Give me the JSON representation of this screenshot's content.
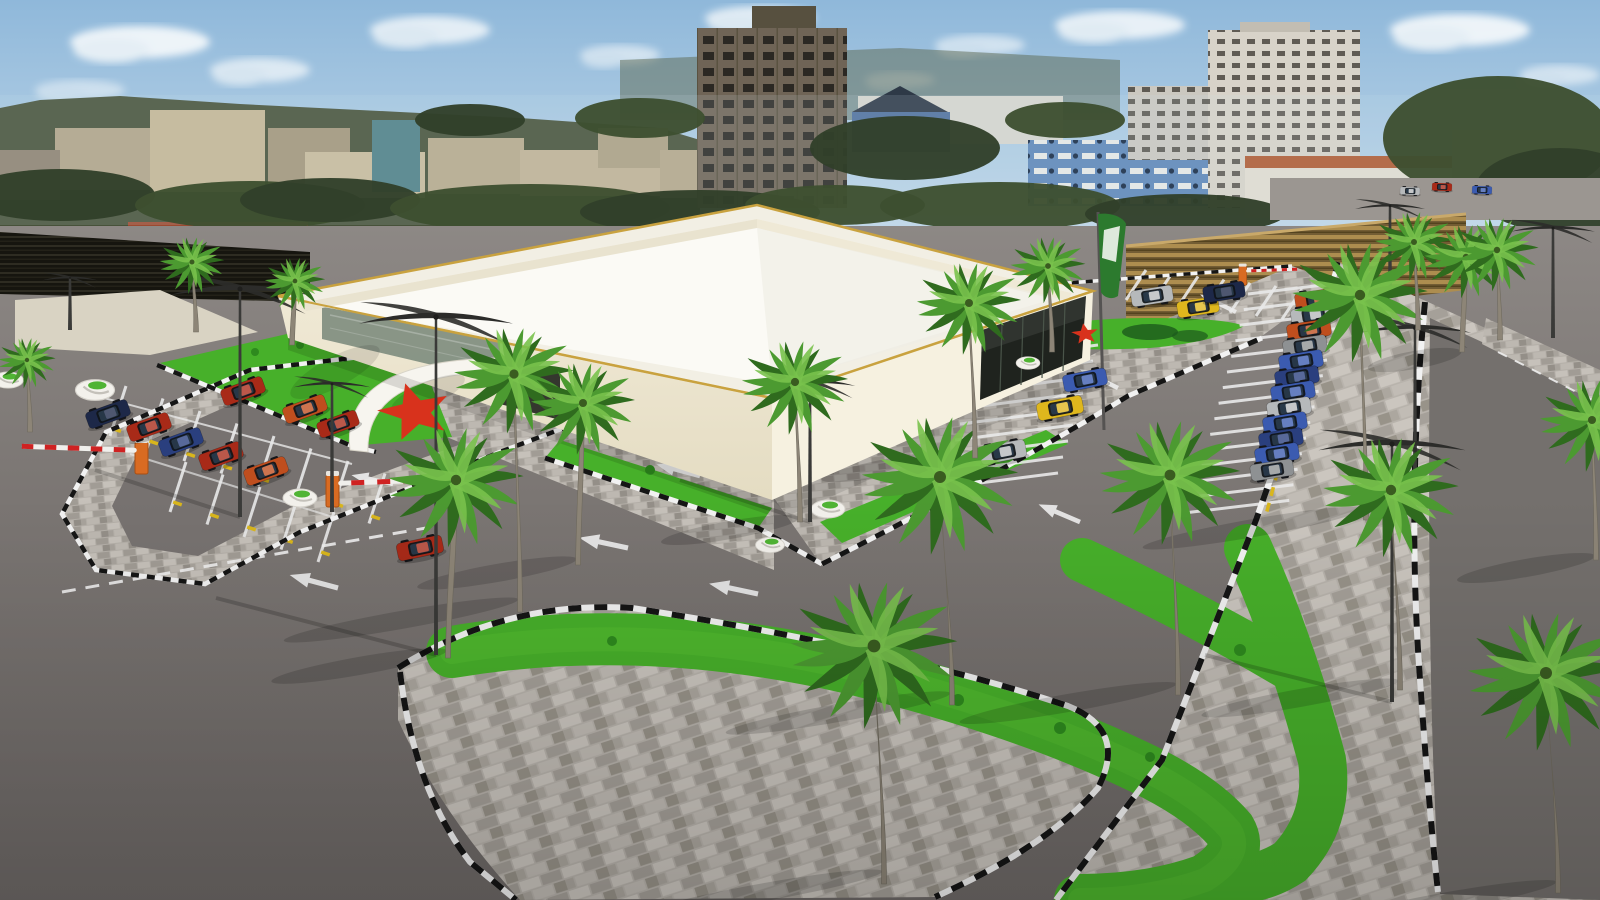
{
  "scene": {
    "description": "3D architectural rendering of a supermarket building with landscaped parking lot, palm trees and city skyline",
    "palette": {
      "skyTop": "#8fb8da",
      "skyBottom": "#dcE9f2",
      "cloud": "#f7fafc",
      "asphalt": "#7b7673",
      "asphaltFar": "#8d8885",
      "paver": "#b4afa8",
      "paverLight": "#c6c1ba",
      "paverDark": "#a19c95",
      "curbBlack": "#151515",
      "curbWhite": "#f2f2f2",
      "grass": "#47b02a",
      "grassLight": "#63cb38",
      "bush": "#2e8a1e",
      "wall": "#ece5cf",
      "wallRight": "#f6f1e0",
      "roof": "#fbfaf5",
      "parapet": "#f2efe4",
      "gold": "#c9a23f",
      "glassDark": "#1f231e",
      "starRed": "#d8321c",
      "trunk": "#8d8577",
      "palmDark": "#2f6b1e",
      "palmMid": "#4c9a31",
      "palmLight": "#79c24d",
      "hedge": "#31402a",
      "hedge2": "#3d4f30",
      "fenceGold": "#ad8d4f",
      "lampMetal": "#2c2c2a",
      "barrierOrange": "#d96b22",
      "carRed": "#a82a18",
      "carOrange": "#bf4e1e",
      "carNavy": "#1d2848",
      "carBlueDk": "#2a3f7e",
      "carBlue": "#3b5bb0",
      "carSilver": "#b6b9bb",
      "carGray": "#8e9193",
      "carYellow": "#dfb71d",
      "flagGreen": "#2c7a2e",
      "flagWhite": "#e8efe6"
    },
    "render": {
      "clouds": [
        [
          140,
          42,
          70,
          16,
          0.9
        ],
        [
          260,
          70,
          50,
          12,
          0.7
        ],
        [
          430,
          30,
          60,
          14,
          0.8
        ],
        [
          620,
          55,
          40,
          10,
          0.6
        ],
        [
          760,
          18,
          55,
          12,
          0.8
        ],
        [
          980,
          45,
          45,
          10,
          0.6
        ],
        [
          1120,
          25,
          65,
          14,
          0.85
        ],
        [
          1300,
          55,
          45,
          11,
          0.7
        ],
        [
          1460,
          30,
          70,
          16,
          0.9
        ],
        [
          1560,
          75,
          40,
          10,
          0.6
        ],
        [
          80,
          90,
          45,
          10,
          0.5
        ],
        [
          900,
          80,
          35,
          8,
          0.5
        ]
      ],
      "skyline": [
        [
          55,
          128,
          95,
          62,
          "#b2a488",
          ""
        ],
        [
          150,
          110,
          115,
          82,
          "#c5b694",
          ""
        ],
        [
          268,
          128,
          82,
          62,
          "#a3957a",
          ""
        ],
        [
          305,
          152,
          120,
          46,
          "#c9bb9b",
          ""
        ],
        [
          372,
          120,
          48,
          72,
          "#4e7f86",
          ""
        ],
        [
          428,
          138,
          96,
          56,
          "#b7a98b",
          ""
        ],
        [
          520,
          150,
          145,
          46,
          "#c0b294",
          ""
        ],
        [
          598,
          128,
          70,
          40,
          "#ada083",
          ""
        ],
        [
          660,
          150,
          90,
          48,
          "#b5a78a",
          ""
        ],
        [
          752,
          6,
          64,
          26,
          "#57503f",
          ""
        ],
        [
          697,
          28,
          150,
          180,
          "#6f6456",
          "winA"
        ],
        [
          858,
          96,
          205,
          48,
          "#d7d5ce",
          ""
        ],
        [
          852,
          112,
          98,
          40,
          "#50709e",
          ""
        ],
        [
          1028,
          140,
          207,
          66,
          "#5e86b8",
          "winC"
        ],
        [
          1128,
          86,
          86,
          74,
          "#cbc8c0",
          "winB"
        ],
        [
          1208,
          30,
          152,
          178,
          "#d8d3c9",
          "winB"
        ],
        [
          1240,
          22,
          70,
          10,
          "#c2bdb2",
          ""
        ],
        [
          1245,
          156,
          215,
          14,
          "#b05a31",
          ""
        ],
        [
          1245,
          168,
          215,
          50,
          "#e2ddd1",
          ""
        ],
        [
          1452,
          130,
          148,
          60,
          "#c8c3b9",
          ""
        ],
        [
          128,
          222,
          180,
          20,
          "#9c4a30",
          ""
        ],
        [
          0,
          150,
          60,
          50,
          "#8e8270",
          ""
        ]
      ],
      "trees": [
        [
          60,
          195,
          95,
          26
        ],
        [
          250,
          205,
          115,
          24
        ],
        [
          330,
          200,
          90,
          22
        ],
        [
          530,
          208,
          140,
          24
        ],
        [
          700,
          212,
          120,
          22
        ],
        [
          835,
          205,
          90,
          20
        ],
        [
          905,
          148,
          95,
          32
        ],
        [
          1000,
          206,
          120,
          24
        ],
        [
          1185,
          214,
          100,
          20
        ],
        [
          1498,
          138,
          115,
          62
        ],
        [
          1560,
          190,
          85,
          42
        ],
        [
          640,
          118,
          65,
          20
        ],
        [
          470,
          120,
          55,
          16
        ],
        [
          1065,
          120,
          60,
          18
        ]
      ],
      "curbs": [
        [
          "M585,358 L470,344 L250,370 L106,432 L62,514 L96,570 L205,584 L300,532 L400,492 L500,452 L585,420",
          4.5,
          "8 8"
        ],
        [
          "M157,365 L352,446 L376,452",
          4.5,
          "9 9"
        ],
        [
          "M545,458 L758,528 L822,564",
          5,
          "10 10"
        ],
        [
          "M822,564 Q1000,474 1128,396 L1262,338",
          5,
          "10 10"
        ],
        [
          "M1002,288 L1292,266",
          3.5,
          "7 7"
        ],
        [
          "M398,668 Q505,600 632,608 Q900,650 1068,706 Q1128,730 1098,788 Q1048,846 935,897",
          6,
          "13 13"
        ],
        [
          "M400,672 Q414,790 470,862 L516,900",
          6,
          "13 13"
        ],
        [
          "M1310,366 L1256,520 L1162,760 L1056,900",
          6,
          "13 13"
        ],
        [
          "M1338,262 L1310,366",
          5,
          "10 10"
        ],
        [
          "M1425,302 Q1408,480 1418,650 Q1428,800 1438,892",
          6,
          "13 13"
        ]
      ],
      "stallGroups": [
        {
          "x": 126,
          "y": 386,
          "dx": 37,
          "dy": 12.5,
          "lx": -16,
          "ly": 50,
          "n": 8,
          "stop": 0.85
        },
        {
          "x": 186,
          "y": 462,
          "dx": 37,
          "dy": 12.5,
          "lx": -16,
          "ly": 50,
          "n": 5,
          "stop": 0.8
        },
        {
          "x": 1248,
          "y": 294,
          "dx": -4.2,
          "dy": 15.6,
          "lx": 100,
          "ly": -12,
          "n": 15,
          "stop": 0.8
        },
        {
          "x": 980,
          "y": 360,
          "dx": -5,
          "dy": 16,
          "lx": 118,
          "ly": -15,
          "n": 9,
          "stop": 0
        },
        {
          "x": 1126,
          "y": 300,
          "dx": 26,
          "dy": 3.2,
          "lx": 20,
          "ly": -30,
          "n": 7,
          "stop": 0
        }
      ],
      "lines": [
        [
          "M104,398 L352,464",
          2,
          0.8
        ],
        [
          "M130,454 L336,518",
          2,
          0.65
        ]
      ],
      "dashLines": [
        [
          "M62,592 Q240,560 432,527",
          "14 10",
          3
        ],
        [
          "M1498,352 L1600,404",
          "10 9",
          2
        ]
      ],
      "arrows": [
        [
          338,
          588,
          195,
          1
        ],
        [
          628,
          548,
          192,
          1
        ],
        [
          758,
          594,
          192,
          1
        ],
        [
          700,
          476,
          195,
          0.9
        ],
        [
          393,
          484,
          192,
          0.85
        ],
        [
          1080,
          522,
          203,
          0.9
        ],
        [
          1118,
          388,
          206,
          0.85
        ],
        [
          1236,
          312,
          206,
          0.8
        ],
        [
          905,
          648,
          196,
          0.9
        ]
      ],
      "cars": [
        [
          108,
          414,
          -20,
          "carNavy",
          1
        ],
        [
          149,
          427,
          -20,
          "carRed",
          1
        ],
        [
          181,
          442,
          -20,
          "carBlueDk",
          1
        ],
        [
          221,
          456,
          -20,
          "carRed",
          1
        ],
        [
          266,
          471,
          -20,
          "carOrange",
          1
        ],
        [
          243,
          391,
          -20,
          "carRed",
          1
        ],
        [
          305,
          409,
          -20,
          "carOrange",
          1
        ],
        [
          338,
          424,
          -20,
          "carRed",
          0.95
        ],
        [
          420,
          548,
          -12,
          "carRed",
          1.05
        ],
        [
          1317,
          299,
          -9,
          "carOrange",
          1
        ],
        [
          1313,
          315,
          -9,
          "carSilver",
          1
        ],
        [
          1309,
          330,
          -9,
          "carOrange",
          1
        ],
        [
          1305,
          346,
          -9,
          "carGray",
          1
        ],
        [
          1301,
          361,
          -9,
          "carBlue",
          1
        ],
        [
          1297,
          377,
          -9,
          "carBlueDk",
          1
        ],
        [
          1293,
          392,
          -9,
          "carBlue",
          1
        ],
        [
          1289,
          408,
          -9,
          "carSilver",
          1
        ],
        [
          1285,
          423,
          -9,
          "carBlue",
          1
        ],
        [
          1281,
          439,
          -9,
          "carBlueDk",
          1
        ],
        [
          1277,
          454,
          -9,
          "carBlue",
          1
        ],
        [
          1272,
          470,
          -9,
          "carGray",
          0.98
        ],
        [
          1085,
          380,
          -11,
          "carBlue",
          1
        ],
        [
          1060,
          408,
          -11,
          "carYellow",
          1.05
        ],
        [
          1003,
          452,
          -11,
          "carSilver",
          1.05
        ],
        [
          1152,
          296,
          -9,
          "carSilver",
          0.95
        ],
        [
          1198,
          307,
          -9,
          "carYellow",
          0.95
        ],
        [
          1224,
          292,
          -9,
          "carNavy",
          0.95
        ],
        [
          1410,
          191,
          2,
          "carSilver",
          0.45
        ],
        [
          1442,
          187,
          2,
          "carRed",
          0.45
        ],
        [
          1482,
          190,
          2,
          "carBlue",
          0.45
        ]
      ],
      "poles": [
        [
          240,
          517,
          228,
          1
        ],
        [
          332,
          512,
          128,
          0.55
        ],
        [
          436,
          655,
          338,
          1.1
        ],
        [
          810,
          522,
          140,
          0.65
        ],
        [
          1415,
          478,
          150,
          0.8
        ],
        [
          1392,
          702,
          258,
          1.05
        ],
        [
          1553,
          338,
          110,
          0.6
        ],
        [
          70,
          330,
          52,
          0.4
        ],
        [
          1390,
          298,
          92,
          0.5
        ]
      ],
      "poleShadows": [
        [
          436,
          655,
          216,
          598
        ],
        [
          240,
          517,
          95,
          470
        ],
        [
          1392,
          702,
          1205,
          655
        ],
        [
          810,
          522,
          680,
          480
        ]
      ],
      "palms": [
        [
          196,
          332,
          70,
          0.62,
          -4
        ],
        [
          292,
          345,
          64,
          0.58,
          3
        ],
        [
          448,
          658,
          178,
          1.3,
          8
        ],
        [
          520,
          612,
          238,
          1.15,
          -6
        ],
        [
          578,
          565,
          162,
          1.0,
          5
        ],
        [
          800,
          522,
          140,
          1.02,
          -5
        ],
        [
          952,
          705,
          228,
          1.5,
          -12
        ],
        [
          884,
          884,
          238,
          1.6,
          -10
        ],
        [
          975,
          458,
          155,
          1.0,
          -6
        ],
        [
          1052,
          352,
          86,
          0.72,
          -4
        ],
        [
          1178,
          695,
          220,
          1.35,
          -8
        ],
        [
          1366,
          520,
          225,
          1.3,
          -6
        ],
        [
          1400,
          690,
          200,
          1.3,
          -9
        ],
        [
          1418,
          330,
          88,
          0.75,
          -4
        ],
        [
          1462,
          352,
          95,
          0.8,
          4
        ],
        [
          1500,
          340,
          90,
          0.8,
          -3
        ],
        [
          1558,
          893,
          220,
          1.5,
          -12
        ],
        [
          1596,
          560,
          140,
          1.0,
          -4
        ],
        [
          30,
          432,
          72,
          0.55,
          -3
        ]
      ],
      "bushes": [
        [
          845,
          662,
          7
        ],
        [
          958,
          700,
          6
        ],
        [
          1060,
          728,
          6
        ],
        [
          612,
          641,
          5
        ],
        [
          1240,
          650,
          6
        ],
        [
          1150,
          757,
          5
        ],
        [
          255,
          352,
          4
        ],
        [
          300,
          345,
          4
        ],
        [
          345,
          358,
          4
        ],
        [
          650,
          470,
          5
        ],
        [
          720,
          256,
          5
        ]
      ],
      "planters": [
        [
          300,
          498,
          1
        ],
        [
          95,
          390,
          1.15
        ],
        [
          828,
          509,
          1
        ],
        [
          948,
          474,
          1
        ],
        [
          770,
          545,
          0.85
        ],
        [
          1028,
          363,
          0.7
        ],
        [
          8,
          380,
          0.9
        ]
      ],
      "barriers": [
        [
          333,
          505,
          1,
          130,
          1
        ],
        [
          142,
          472,
          -1,
          115,
          1
        ],
        [
          1243,
          284,
          1,
          85,
          0.6
        ]
      ],
      "stars": [
        [
          415,
          412,
          38,
          -15
        ],
        [
          1085,
          334,
          14,
          -8
        ]
      ],
      "greenStrokes": [
        [
          "M452,652 Q640,620 850,668 Q1020,710 1135,765 Q1200,795 1230,830 Q1245,855 1205,880 Q1150,900 1080,900",
          52
        ],
        [
          "M1248,548 Q1290,640 1322,760 Q1330,820 1290,862 Q1255,885 1205,880",
          48
        ],
        [
          "M1082,560 Q1200,615 1295,672",
          0
        ]
      ]
    }
  }
}
